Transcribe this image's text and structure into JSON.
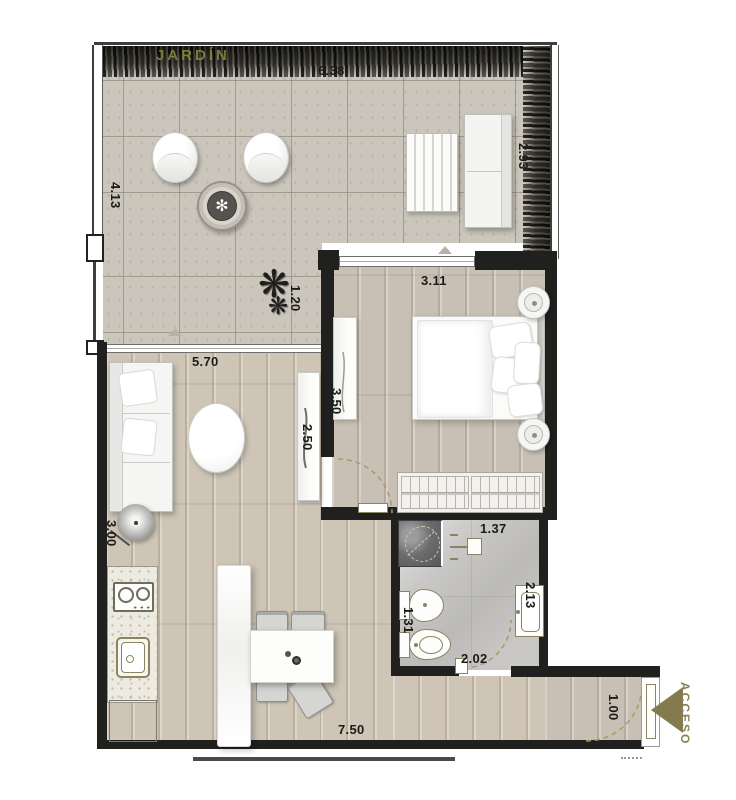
{
  "plan_texts": {
    "garden": "JARDÍN",
    "access": "ACCESO"
  },
  "dims": {
    "terrace_top": "6.38",
    "terrace_left": "4.13",
    "terrace_right": "2.93",
    "terrace_step": "1.20",
    "bedroom_top": "3.11",
    "bedroom_side": "3.50",
    "living_side": "2.50",
    "living_top": "5.70",
    "living_left": "3.00",
    "bath_top": "1.37",
    "bath_left": "1.31",
    "bath_vanity": "2.13",
    "bath_bottom": "2.02",
    "kitchen_bottom": "7.50",
    "entry_door": "1.00"
  },
  "colors": {
    "wall": "#20201f",
    "accent_olive": "#8a8050",
    "door_arc": "#a59b66",
    "wood_floor": "#cec5b6",
    "tile_floor": "#cbc6bb",
    "bath_floor": "#c8c7c5"
  }
}
